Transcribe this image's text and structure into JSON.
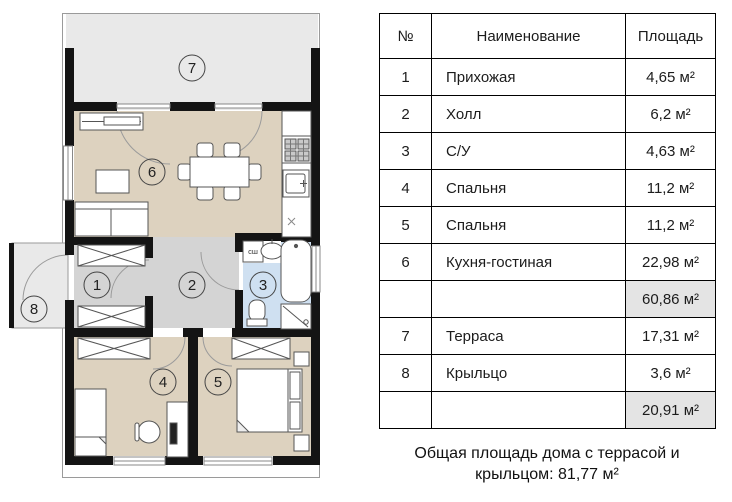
{
  "plan": {
    "rooms": [
      {
        "label": "1"
      },
      {
        "label": "2"
      },
      {
        "label": "3"
      },
      {
        "label": "4"
      },
      {
        "label": "5"
      },
      {
        "label": "6"
      },
      {
        "label": "7"
      },
      {
        "label": "8"
      }
    ],
    "washer_label": "сш",
    "colors": {
      "wall": "#141414",
      "living_rooms": "#ddd2bf",
      "hallway": "#d4d4d4",
      "bathroom": "#cfe0f1",
      "terrace": "#e9e9e9"
    }
  },
  "table": {
    "headers": {
      "num": "№",
      "name": "Наименование",
      "area": "Площадь"
    },
    "rows": [
      {
        "num": "1",
        "name": "Прихожая",
        "area": "4,65 м²"
      },
      {
        "num": "2",
        "name": "Холл",
        "area": "6,2 м²"
      },
      {
        "num": "3",
        "name": "С/У",
        "area": "4,63 м²"
      },
      {
        "num": "4",
        "name": "Спальня",
        "area": "11,2 м²"
      },
      {
        "num": "5",
        "name": "Спальня",
        "area": "11,2 м²"
      },
      {
        "num": "6",
        "name": "Кухня-гостиная",
        "area": "22,98 м²"
      },
      {
        "num": "",
        "name": "",
        "area": "60,86 м²"
      },
      {
        "num": "7",
        "name": "Терраса",
        "area": "17,31 м²"
      },
      {
        "num": "8",
        "name": "Крыльцо",
        "area": "3,6 м²"
      },
      {
        "num": "",
        "name": "",
        "area": "20,91 м²"
      }
    ],
    "caption_line1": "Общая площадь дома с террасой и",
    "caption_line2": "крыльцом: 81,77 м²"
  }
}
